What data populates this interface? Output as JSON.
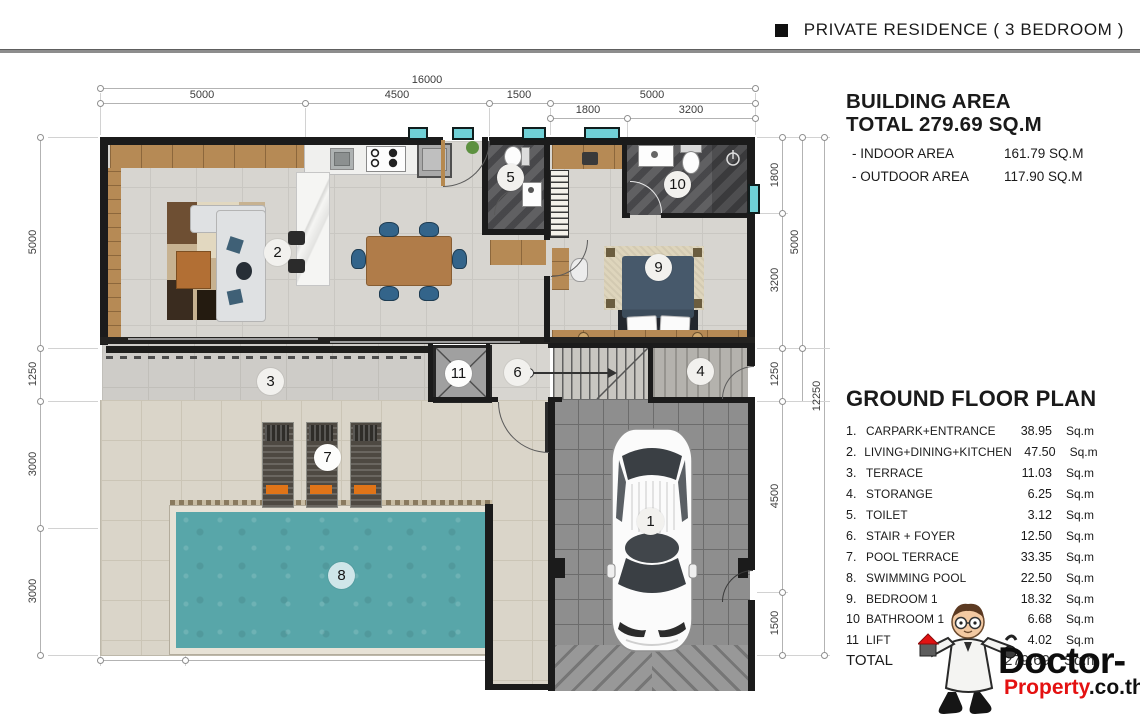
{
  "header": {
    "bullet": "■",
    "title": "PRIVATE RESIDENCE  ( 3 BEDROOM )"
  },
  "building_area": {
    "title_line1": "BUILDING AREA",
    "title_line2": "TOTAL 279.69 SQ.M",
    "rows": [
      {
        "label": "- INDOOR AREA",
        "value": "161.79 SQ.M"
      },
      {
        "label": "- OUTDOOR AREA",
        "value": "117.90 SQ.M"
      }
    ]
  },
  "floor_plan_panel": {
    "title": "GROUND FLOOR PLAN",
    "legend": [
      {
        "num": "1.",
        "name": "CARPARK+ENTRANCE",
        "area": "38.95",
        "unit": "Sq.m"
      },
      {
        "num": "2.",
        "name": "LIVING+DINING+KITCHEN",
        "area": "47.50",
        "unit": "Sq.m"
      },
      {
        "num": "3.",
        "name": "TERRACE",
        "area": "11.03",
        "unit": "Sq.m"
      },
      {
        "num": "4.",
        "name": "STORANGE",
        "area": "6.25",
        "unit": "Sq.m"
      },
      {
        "num": "5.",
        "name": "TOILET",
        "area": "3.12",
        "unit": "Sq.m"
      },
      {
        "num": "6.",
        "name": "STAIR + FOYER",
        "area": "12.50",
        "unit": "Sq.m"
      },
      {
        "num": "7.",
        "name": "POOL TERRACE",
        "area": "33.35",
        "unit": "Sq.m"
      },
      {
        "num": "8.",
        "name": "SWIMMING POOL",
        "area": "22.50",
        "unit": "Sq.m"
      },
      {
        "num": "9.",
        "name": "BEDROOM 1",
        "area": "18.32",
        "unit": "Sq.m"
      },
      {
        "num": "10",
        "name": "BATHROOM 1",
        "area": "6.68",
        "unit": "Sq.m"
      },
      {
        "num": "11",
        "name": "LIFT",
        "area": "4.02",
        "unit": "Sq.m"
      }
    ],
    "total_label": "TOTAL",
    "total_value": "279.69",
    "total_unit": "Sq.m"
  },
  "logo": {
    "brand_top": "Doctor-",
    "brand_red": "Property",
    "brand_black": ".co.th"
  },
  "dimensions": {
    "top_total": "16000",
    "top_row": [
      "5000",
      "4500",
      "1500",
      "5000"
    ],
    "top_sub": [
      "1800",
      "3200"
    ],
    "left": [
      "5000",
      "1250",
      "3000",
      "3000"
    ],
    "right_inner": [
      "1800",
      "3200",
      "1250",
      "4500",
      "1500"
    ],
    "right_mid": "5000",
    "right_total": "12250",
    "bottom": [
      "2000",
      "7500"
    ]
  },
  "plan": {
    "rooms": [
      {
        "number": "1",
        "name": "carpark-entrance"
      },
      {
        "number": "2",
        "name": "living-dining-kitchen"
      },
      {
        "number": "3",
        "name": "terrace"
      },
      {
        "number": "4",
        "name": "storage"
      },
      {
        "number": "5",
        "name": "toilet"
      },
      {
        "number": "6",
        "name": "stair-foyer"
      },
      {
        "number": "7",
        "name": "pool-terrace"
      },
      {
        "number": "8",
        "name": "swimming-pool"
      },
      {
        "number": "9",
        "name": "bedroom-1"
      },
      {
        "number": "10",
        "name": "bathroom-1"
      },
      {
        "number": "11",
        "name": "lift"
      }
    ]
  },
  "colors": {
    "pool_water": "#58a6a9",
    "logo_red": "#e41111",
    "wall": "#1b1b1b",
    "wood": "#b68a55"
  }
}
